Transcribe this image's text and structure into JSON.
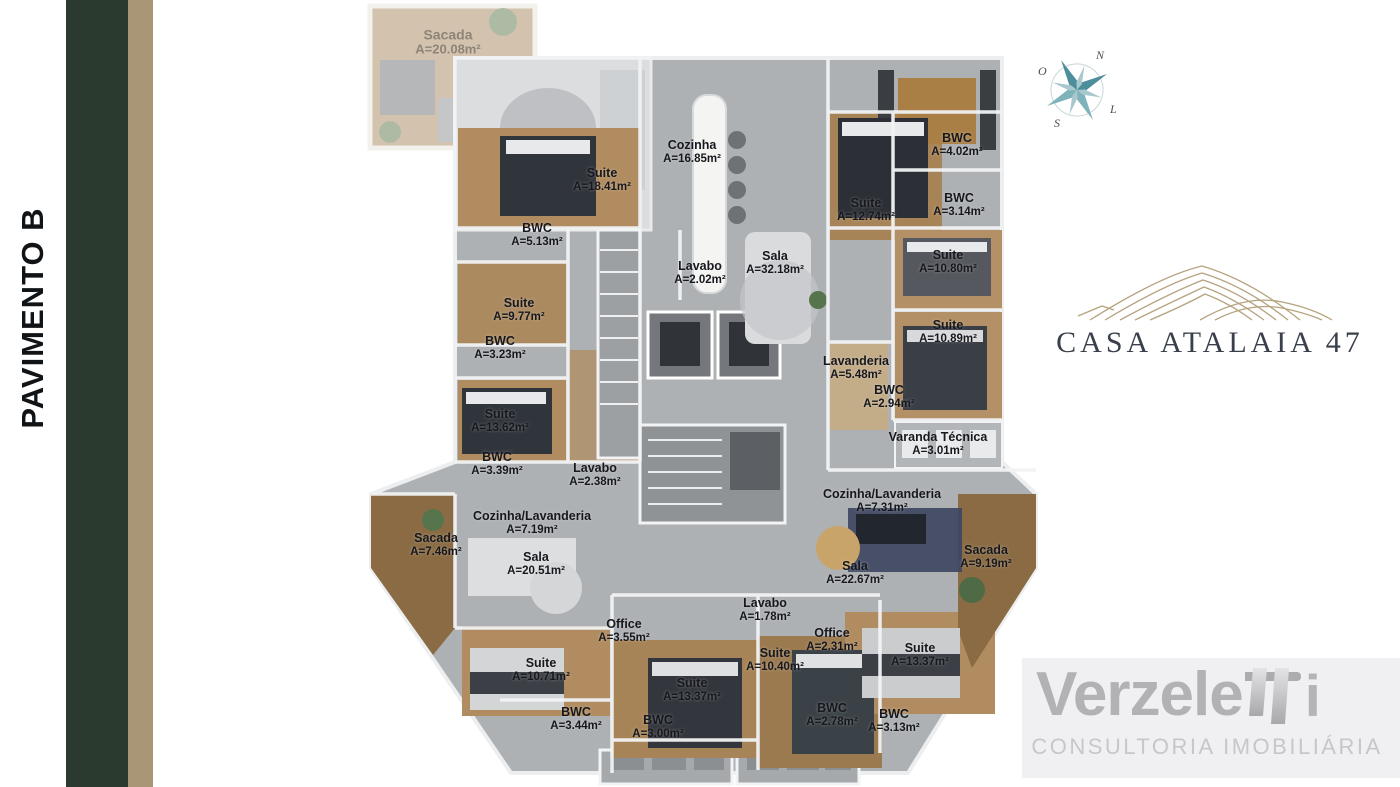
{
  "sidebar": {
    "floor_label": "PAVIMENTO B"
  },
  "compass": {
    "north": "N",
    "west": "O",
    "east": "L",
    "south": "S"
  },
  "logo": {
    "title": "CASA ATALAIA 47"
  },
  "watermark": {
    "brand": "Verzele",
    "brand_suffix": "i",
    "subtitle": "CONSULTORIA IMOBILIÁRIA"
  },
  "floorplan": {
    "rooms": [
      {
        "name": "Sacada",
        "area": "A=20.08m²",
        "x": 448,
        "y": 42,
        "faded": true
      },
      {
        "name": "Suite",
        "area": "A=18.41m²",
        "x": 602,
        "y": 180
      },
      {
        "name": "Cozinha",
        "area": "A=16.85m²",
        "x": 692,
        "y": 152
      },
      {
        "name": "BWC",
        "area": "A=5.13m²",
        "x": 537,
        "y": 235
      },
      {
        "name": "Suite",
        "area": "A=12.74m²",
        "x": 866,
        "y": 210
      },
      {
        "name": "BWC",
        "area": "A=4.02m²",
        "x": 957,
        "y": 145
      },
      {
        "name": "BWC",
        "area": "A=3.14m²",
        "x": 959,
        "y": 205
      },
      {
        "name": "Sala",
        "area": "A=32.18m²",
        "x": 775,
        "y": 263
      },
      {
        "name": "Lavabo",
        "area": "A=2.02m²",
        "x": 700,
        "y": 273
      },
      {
        "name": "Suite",
        "area": "A=10.80m²",
        "x": 948,
        "y": 262
      },
      {
        "name": "Suite",
        "area": "A=9.77m²",
        "x": 519,
        "y": 310
      },
      {
        "name": "BWC",
        "area": "A=3.23m²",
        "x": 500,
        "y": 348
      },
      {
        "name": "Suite",
        "area": "A=10.89m²",
        "x": 948,
        "y": 332
      },
      {
        "name": "Lavanderia",
        "area": "A=5.48m²",
        "x": 856,
        "y": 368
      },
      {
        "name": "BWC",
        "area": "A=2.94m²",
        "x": 889,
        "y": 397
      },
      {
        "name": "Suite",
        "area": "A=13.62m²",
        "x": 500,
        "y": 421
      },
      {
        "name": "Varanda Técnica",
        "area": "A=3.01m²",
        "x": 938,
        "y": 444
      },
      {
        "name": "BWC",
        "area": "A=3.39m²",
        "x": 497,
        "y": 464
      },
      {
        "name": "Lavabo",
        "area": "A=2.38m²",
        "x": 595,
        "y": 475
      },
      {
        "name": "Cozinha/Lavanderia",
        "area": "A=7.19m²",
        "x": 532,
        "y": 523
      },
      {
        "name": "Cozinha/Lavanderia",
        "area": "A=7.31m²",
        "x": 882,
        "y": 501
      },
      {
        "name": "Sacada",
        "area": "A=7.46m²",
        "x": 436,
        "y": 545
      },
      {
        "name": "Sala",
        "area": "A=20.51m²",
        "x": 536,
        "y": 564
      },
      {
        "name": "Sala",
        "area": "A=22.67m²",
        "x": 855,
        "y": 573
      },
      {
        "name": "Sacada",
        "area": "A=9.19m²",
        "x": 986,
        "y": 557
      },
      {
        "name": "Lavabo",
        "area": "A=1.78m²",
        "x": 765,
        "y": 610
      },
      {
        "name": "Office",
        "area": "A=3.55m²",
        "x": 624,
        "y": 631
      },
      {
        "name": "Office",
        "area": "A=2.31m²",
        "x": 832,
        "y": 640
      },
      {
        "name": "Suite",
        "area": "A=10.40m²",
        "x": 775,
        "y": 660
      },
      {
        "name": "Suite",
        "area": "A=10.71m²",
        "x": 541,
        "y": 670
      },
      {
        "name": "Suite",
        "area": "A=13.37m²",
        "x": 692,
        "y": 690
      },
      {
        "name": "Suite",
        "area": "A=13.37m²",
        "x": 920,
        "y": 655
      },
      {
        "name": "BWC",
        "area": "A=3.44m²",
        "x": 576,
        "y": 719
      },
      {
        "name": "BWC",
        "area": "A=3.00m²",
        "x": 658,
        "y": 727
      },
      {
        "name": "BWC",
        "area": "A=2.78m²",
        "x": 832,
        "y": 715
      },
      {
        "name": "BWC",
        "area": "A=3.13m²",
        "x": 894,
        "y": 721
      }
    ]
  }
}
